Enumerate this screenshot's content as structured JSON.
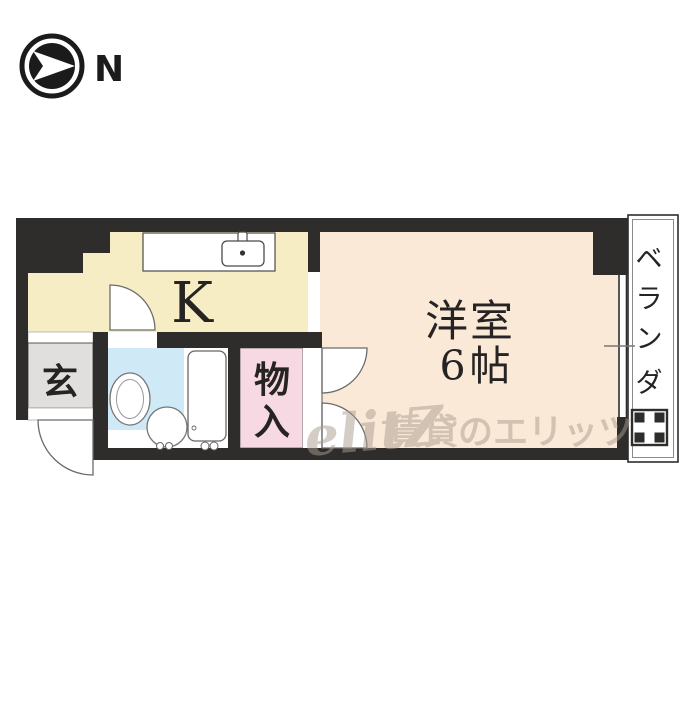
{
  "compass": {
    "north_label": "N"
  },
  "plan": {
    "kitchen": {
      "label": "K"
    },
    "western_room": {
      "label": "洋室",
      "size_label": "6帖"
    },
    "entrance": {
      "label": "玄"
    },
    "storage": {
      "char1": "物",
      "char2": "入"
    },
    "veranda": {
      "char1": "ベ",
      "char2": "ラ",
      "char3": "ン",
      "char4": "ダ"
    },
    "colors": {
      "wall": "#2f2d2c",
      "kitchen_floor": "#f7edc5",
      "western_room_floor": "#fbe9d8",
      "storage_floor": "#f7d9e3",
      "bathroom_floor": "#cfe9f7",
      "entrance_floor": "#e0dfdd"
    }
  },
  "watermark": {
    "logo": "elitZ",
    "text": "賃貸のエリッツ"
  }
}
